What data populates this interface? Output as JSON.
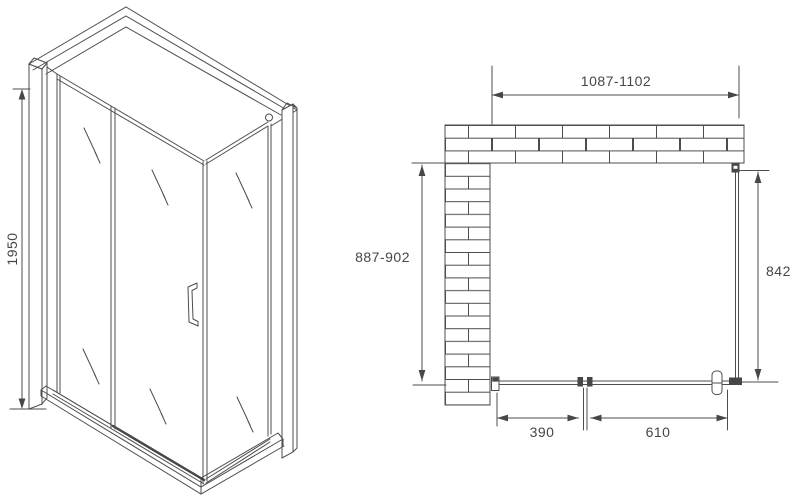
{
  "colors": {
    "background": "#ffffff",
    "line": "#4d4d4d",
    "dark_fill": "#474747",
    "text": "#464646"
  },
  "front_view": {
    "height_dimension": "1950"
  },
  "plan_view": {
    "width_dimension": "1087-1102",
    "depth_dimension": "887-902",
    "side_panel_dimension": "842",
    "fixed_panel_dimension": "390",
    "door_dimension": "610"
  }
}
